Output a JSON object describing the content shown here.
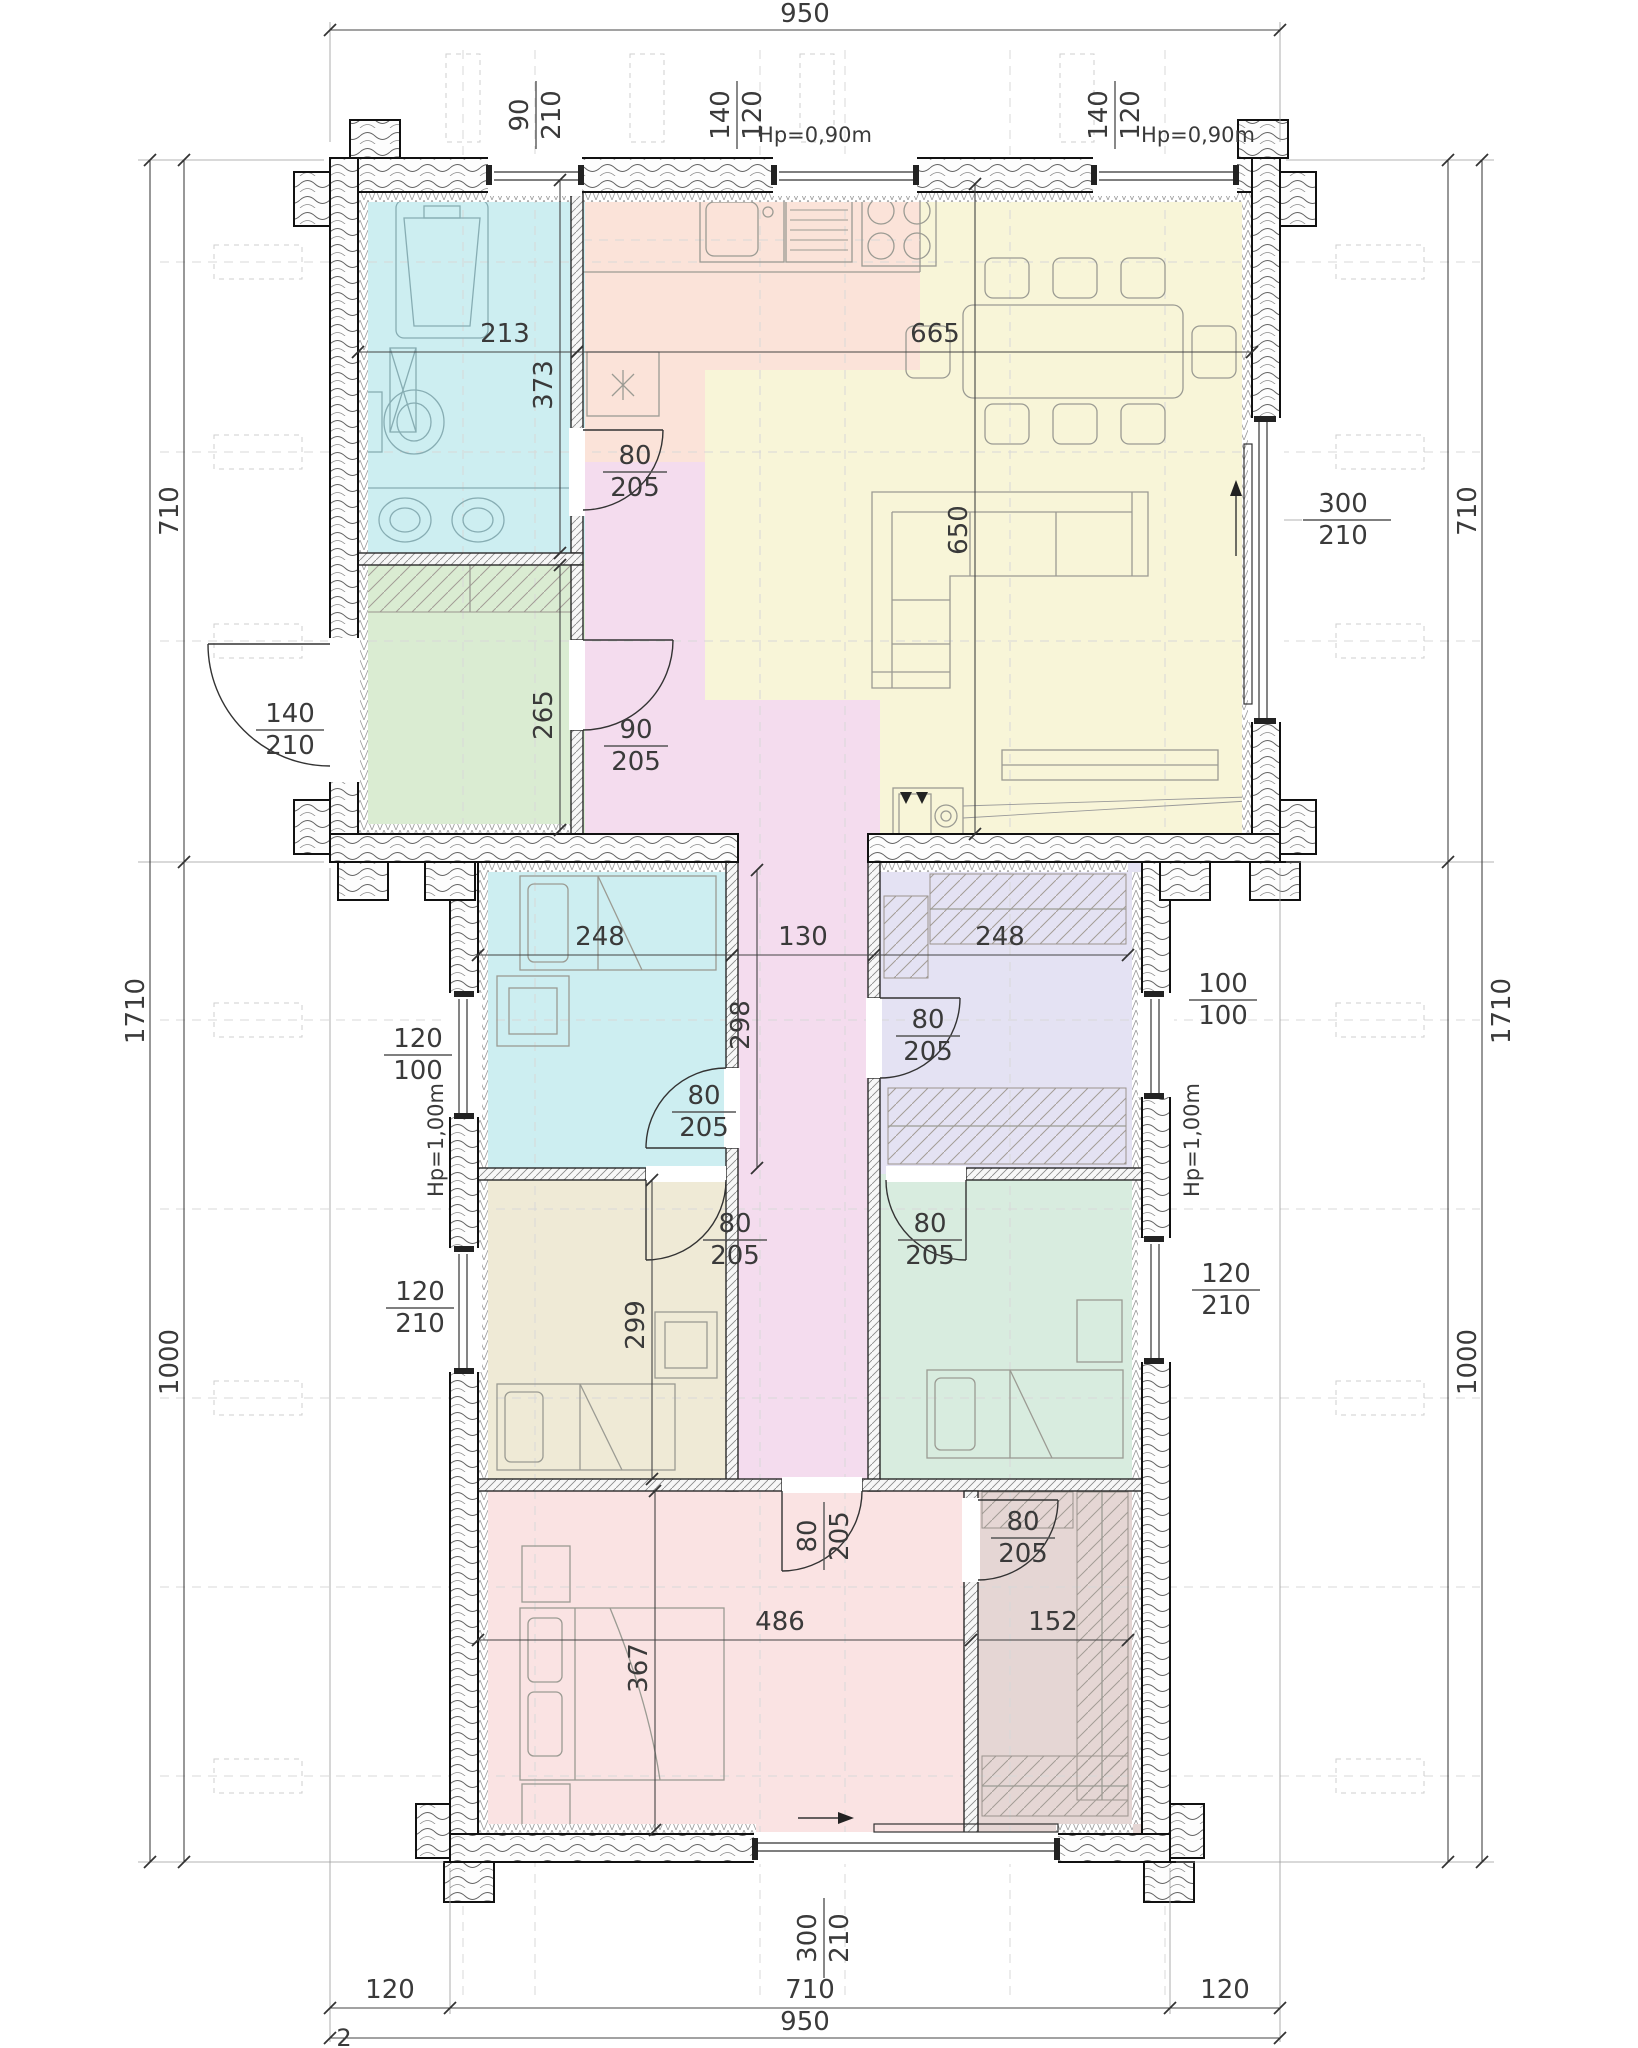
{
  "drawing": {
    "dims": {
      "top_total": "950",
      "bottom_total": "950",
      "bottom_left": "120",
      "bottom_mid": "710",
      "bottom_right": "120",
      "left_total": "1710",
      "left_top": "710",
      "left_bottom": "1000",
      "right_total": "1710",
      "right_top": "710",
      "right_bottom": "1000",
      "grid": "2",
      "bath_w": "213",
      "bath_h": "373",
      "utility_h": "265",
      "living_w": "665",
      "living_h": "650",
      "bed1_w": "248",
      "hall_w": "130",
      "dress_w": "248",
      "bed1_h": "298",
      "bed2_h": "299",
      "master_w": "486",
      "master_h": "367",
      "closet_w": "152"
    },
    "openings": {
      "win_bath": {
        "w": "90",
        "h": "210"
      },
      "win_kitchen": {
        "w": "140",
        "h": "120",
        "hp": "Hp=0,90m"
      },
      "win_dining": {
        "w": "140",
        "h": "120",
        "hp": "Hp=0,90m"
      },
      "door_entrance": {
        "w": "140",
        "h": "210"
      },
      "door_utility": {
        "w": "90",
        "h": "205"
      },
      "door_bath": {
        "w": "80",
        "h": "205"
      },
      "door_bed1": {
        "w": "80",
        "h": "205"
      },
      "door_dress": {
        "w": "80",
        "h": "205"
      },
      "door_bed2": {
        "w": "80",
        "h": "205"
      },
      "door_bed3": {
        "w": "80",
        "h": "205"
      },
      "door_master": {
        "w": "80",
        "h": "205"
      },
      "door_closet": {
        "w": "80",
        "h": "205"
      },
      "slide_living": {
        "w": "300",
        "h": "210"
      },
      "slide_master": {
        "w": "300",
        "h": "210"
      },
      "win_bed1": {
        "w": "120",
        "h": "100",
        "hp": "Hp=1,00m"
      },
      "win_dress": {
        "w": "100",
        "h": "100",
        "hp": "Hp=1,00m"
      },
      "win_bed2": {
        "w": "120",
        "h": "210"
      },
      "win_bed3": {
        "w": "120",
        "h": "210"
      }
    }
  }
}
